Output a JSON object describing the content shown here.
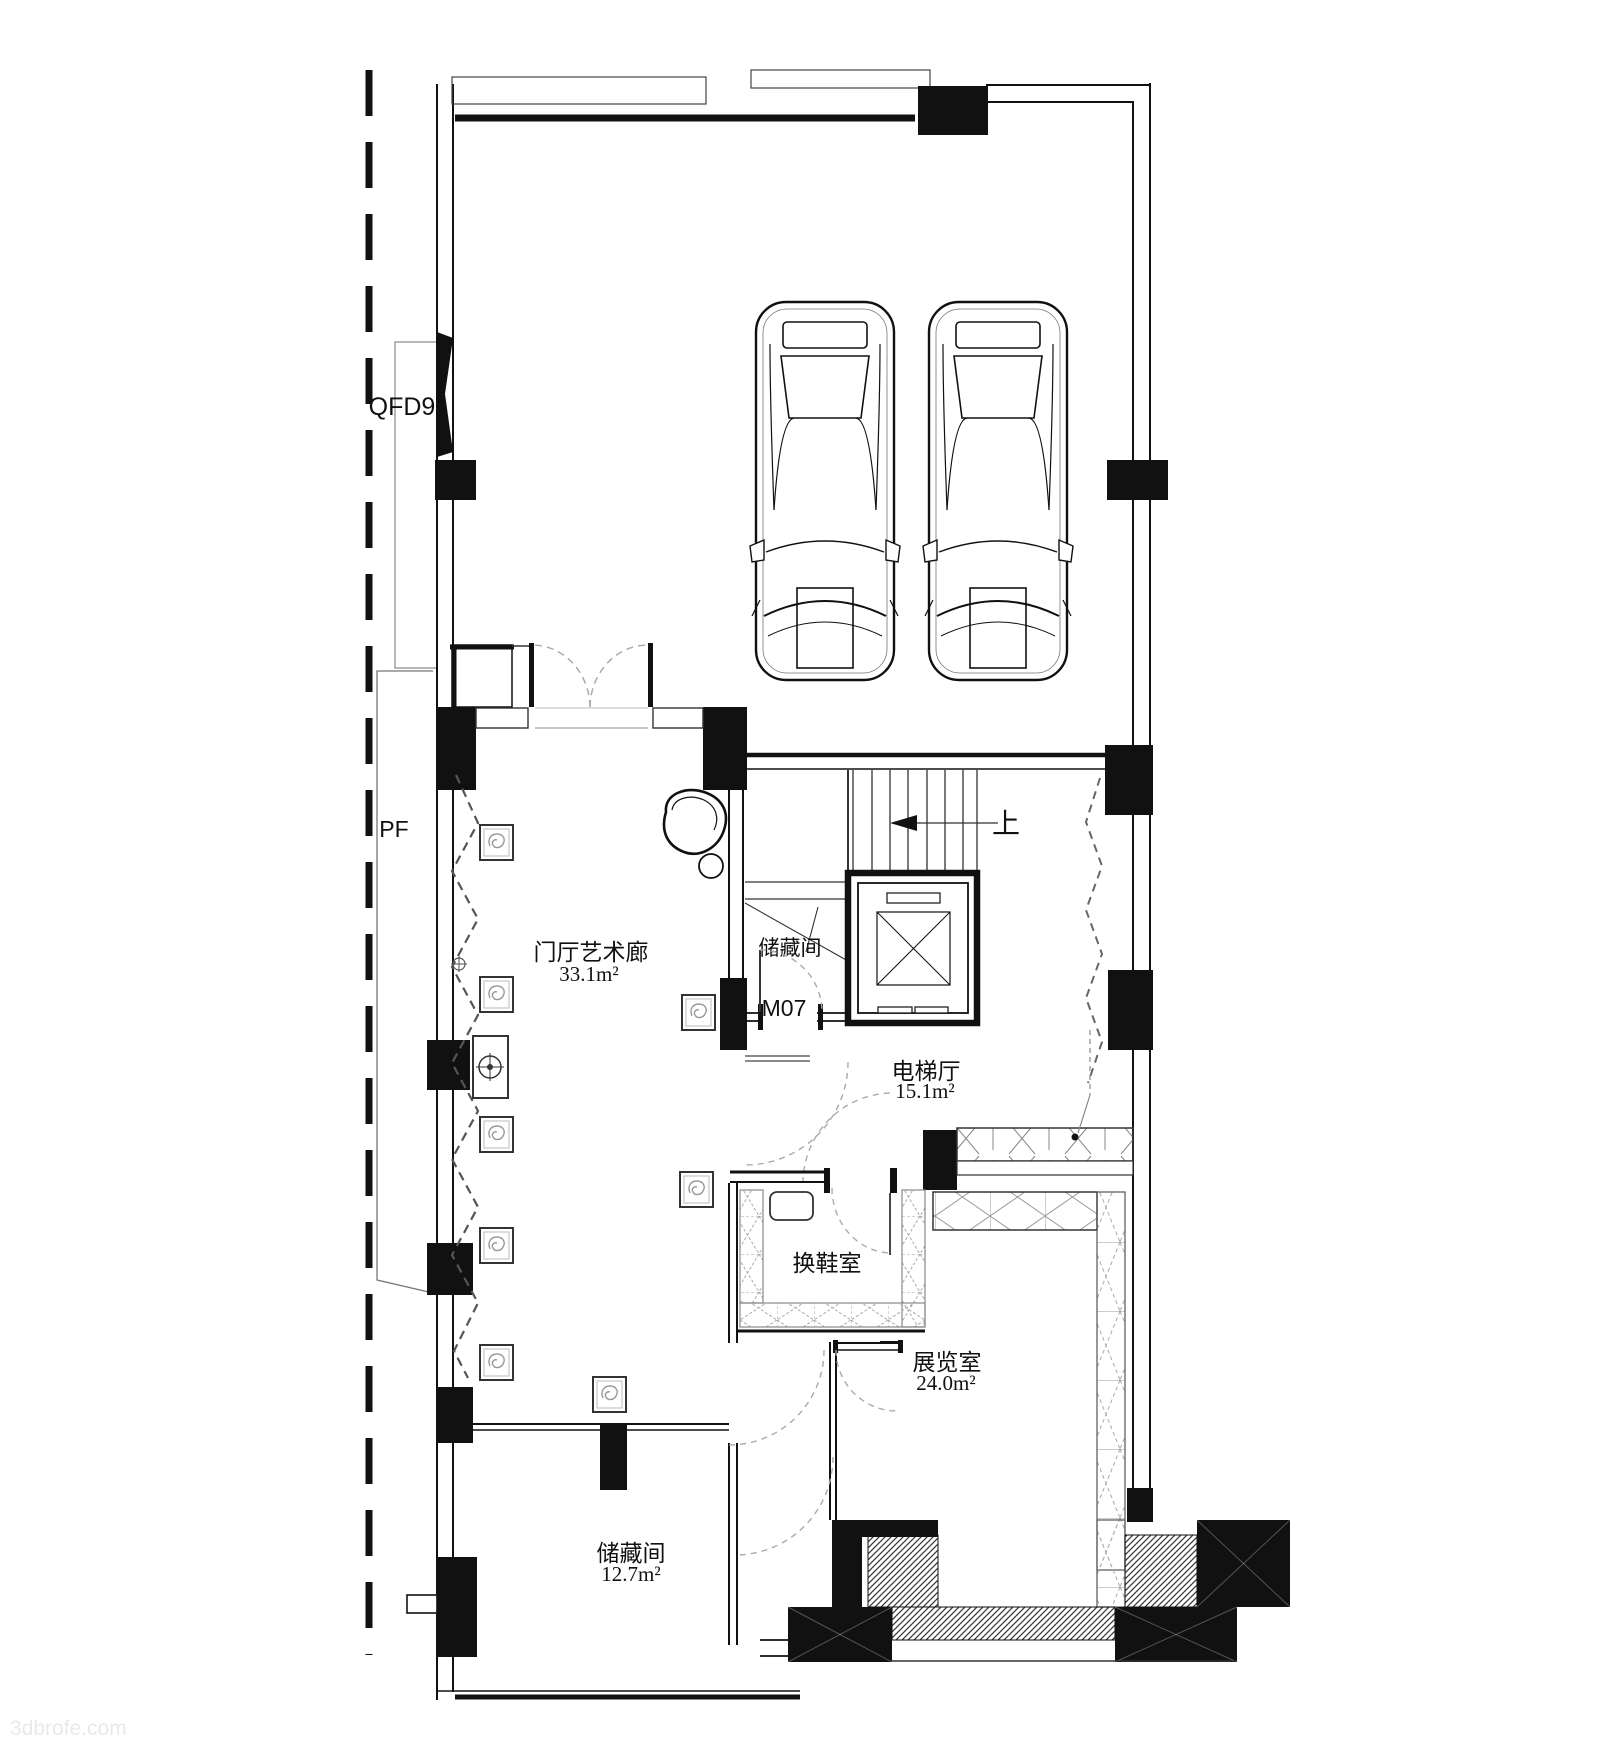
{
  "plan": {
    "boundary": {
      "qfd9_label": "QFD9",
      "pf_label": "PF"
    },
    "stair": {
      "up_label": "上",
      "under_stair_storage_label": "储藏间"
    },
    "doors": {
      "m07_label": "M07"
    },
    "rooms": {
      "hall": {
        "name": "门厅艺术廊",
        "area": "33.1m²"
      },
      "elevator_hall": {
        "name": "电梯厅",
        "area": "15.1m²"
      },
      "shoe_room": {
        "name": "换鞋室"
      },
      "exhibition": {
        "name": "展览室",
        "area": "24.0m²"
      },
      "storage": {
        "name": "储藏间",
        "area": "12.7m²"
      }
    },
    "watermark": "3dbrofe.com",
    "colors": {
      "wall_black": "#111111",
      "line": "#333333",
      "dash_gray": "#999999",
      "hatch": "#444444"
    }
  }
}
